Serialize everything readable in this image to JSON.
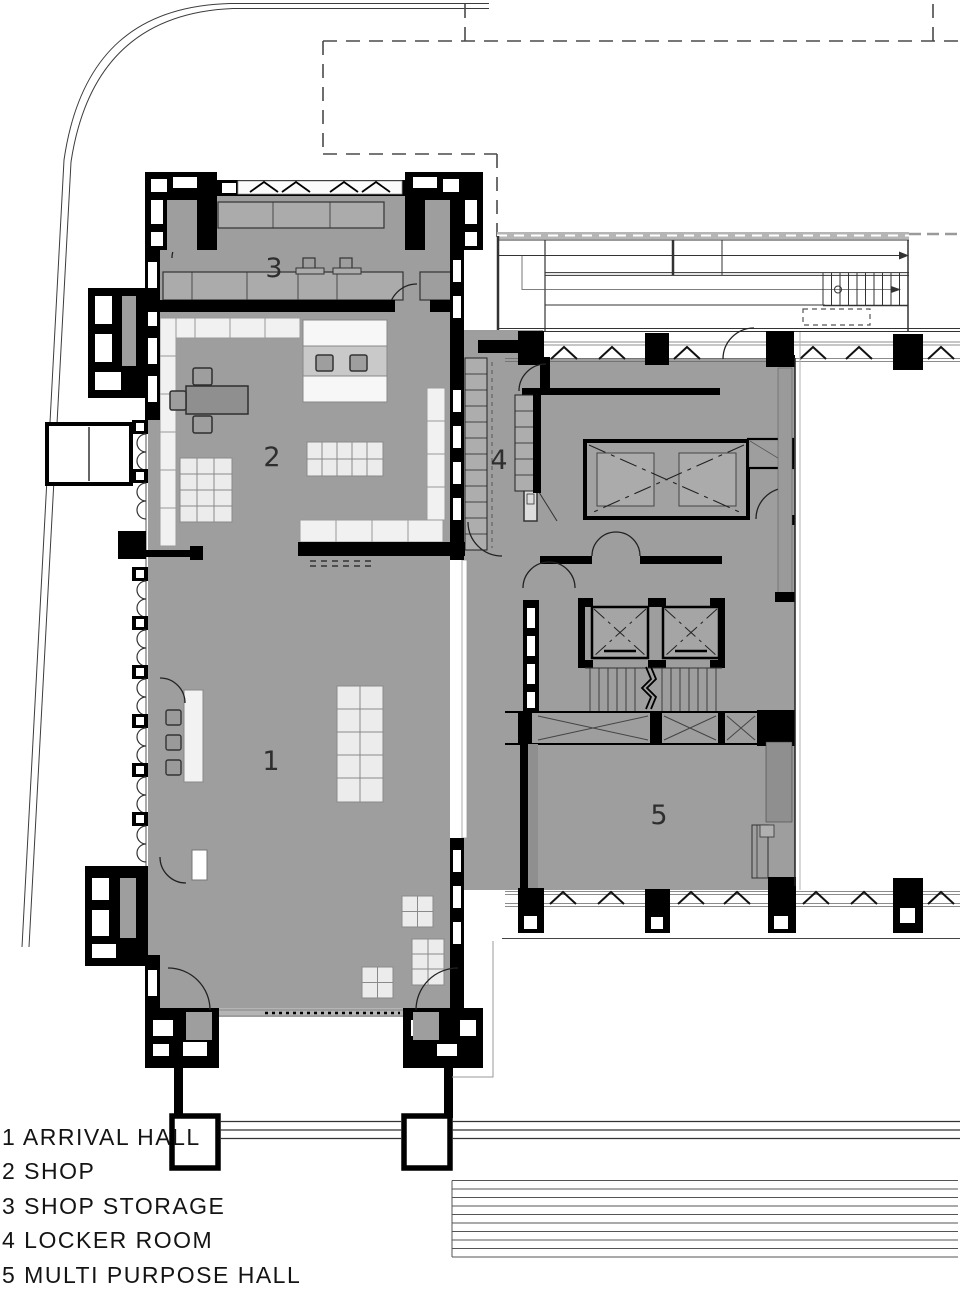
{
  "plan": {
    "room_labels": [
      "1",
      "2",
      "3",
      "4",
      "5"
    ],
    "legend": [
      "1 ARRIVAL HALL",
      "2 SHOP",
      "3 SHOP STORAGE",
      "4 LOCKER ROOM",
      "5 MULTI PURPOSE HALL"
    ],
    "colors": {
      "background": "#ffffff",
      "room_fill": "#9e9e9e",
      "wall": "#000000",
      "overhang_band": "#b5b5b5",
      "furniture_light": "#ececec",
      "site_line": "#444444"
    }
  }
}
